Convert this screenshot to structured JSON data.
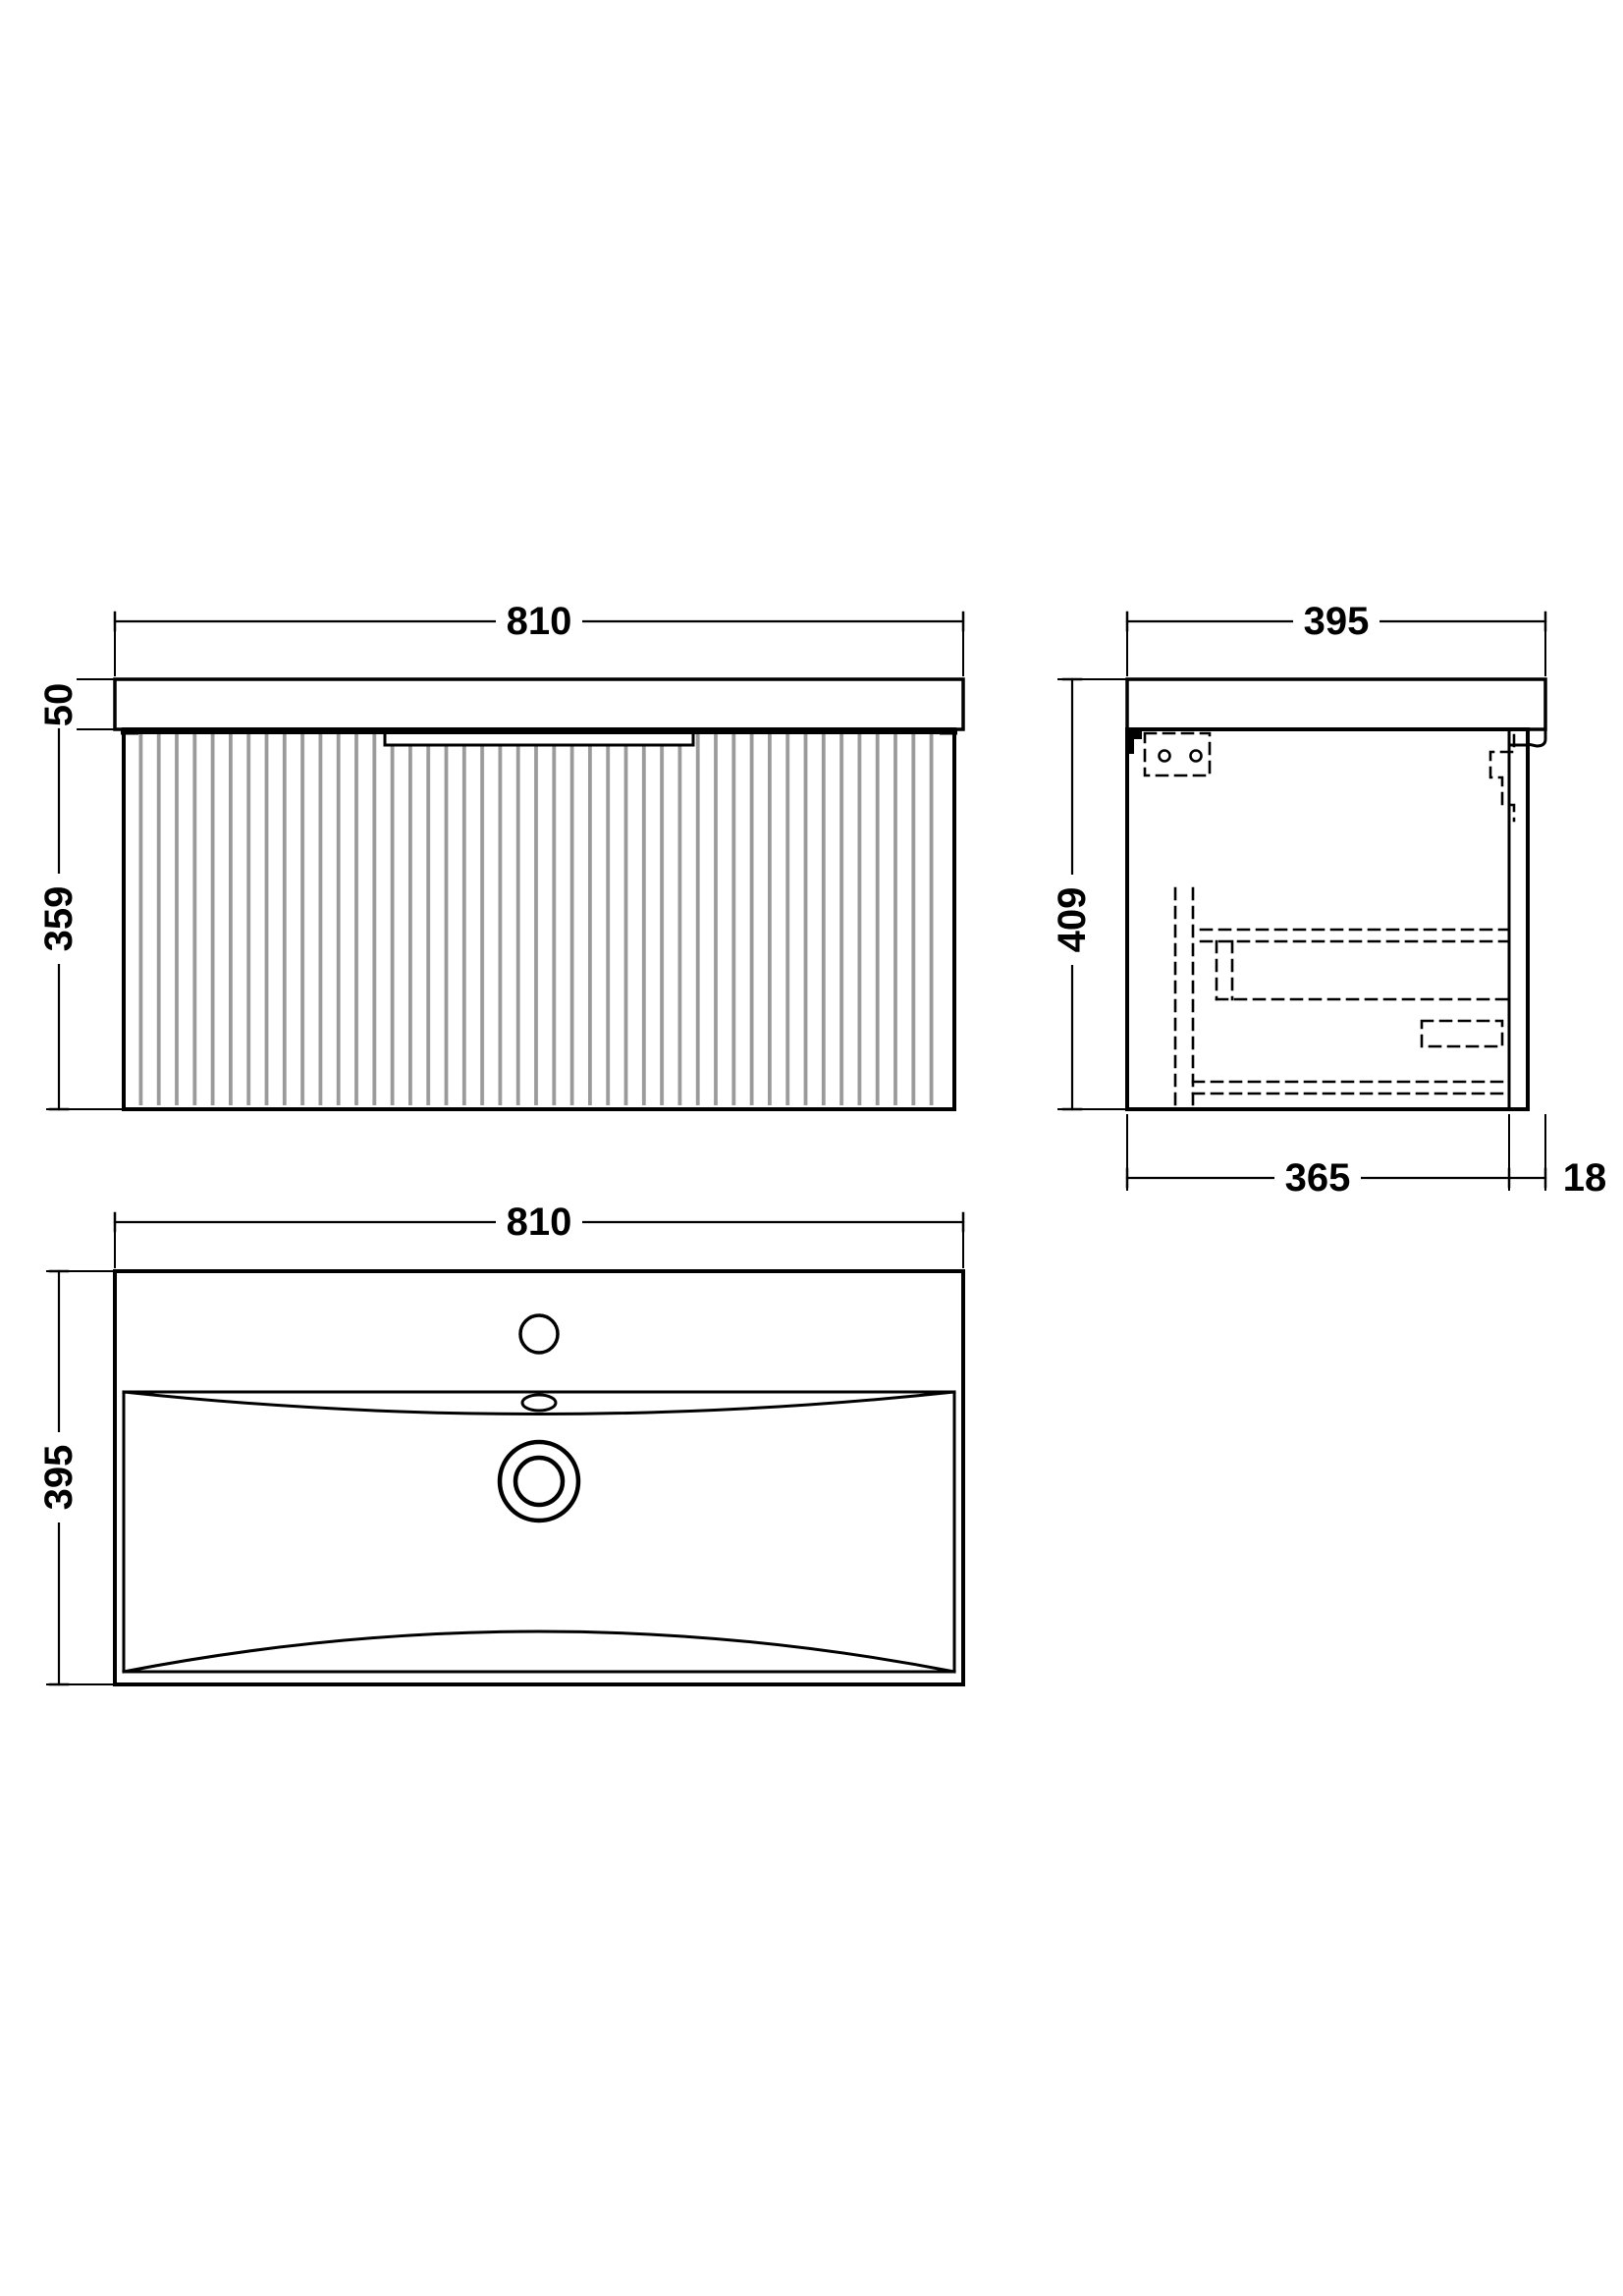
{
  "drawing": {
    "background": "#ffffff",
    "line_color": "#000000",
    "flute_color": "#9a9a9a",
    "front": {
      "width": "810",
      "worktop_height": "50",
      "cabinet_height": "359"
    },
    "side": {
      "depth": "395",
      "height": "409",
      "internal_depth": "365",
      "panel_thickness": "18"
    },
    "plan": {
      "width": "810",
      "depth": "395"
    }
  }
}
